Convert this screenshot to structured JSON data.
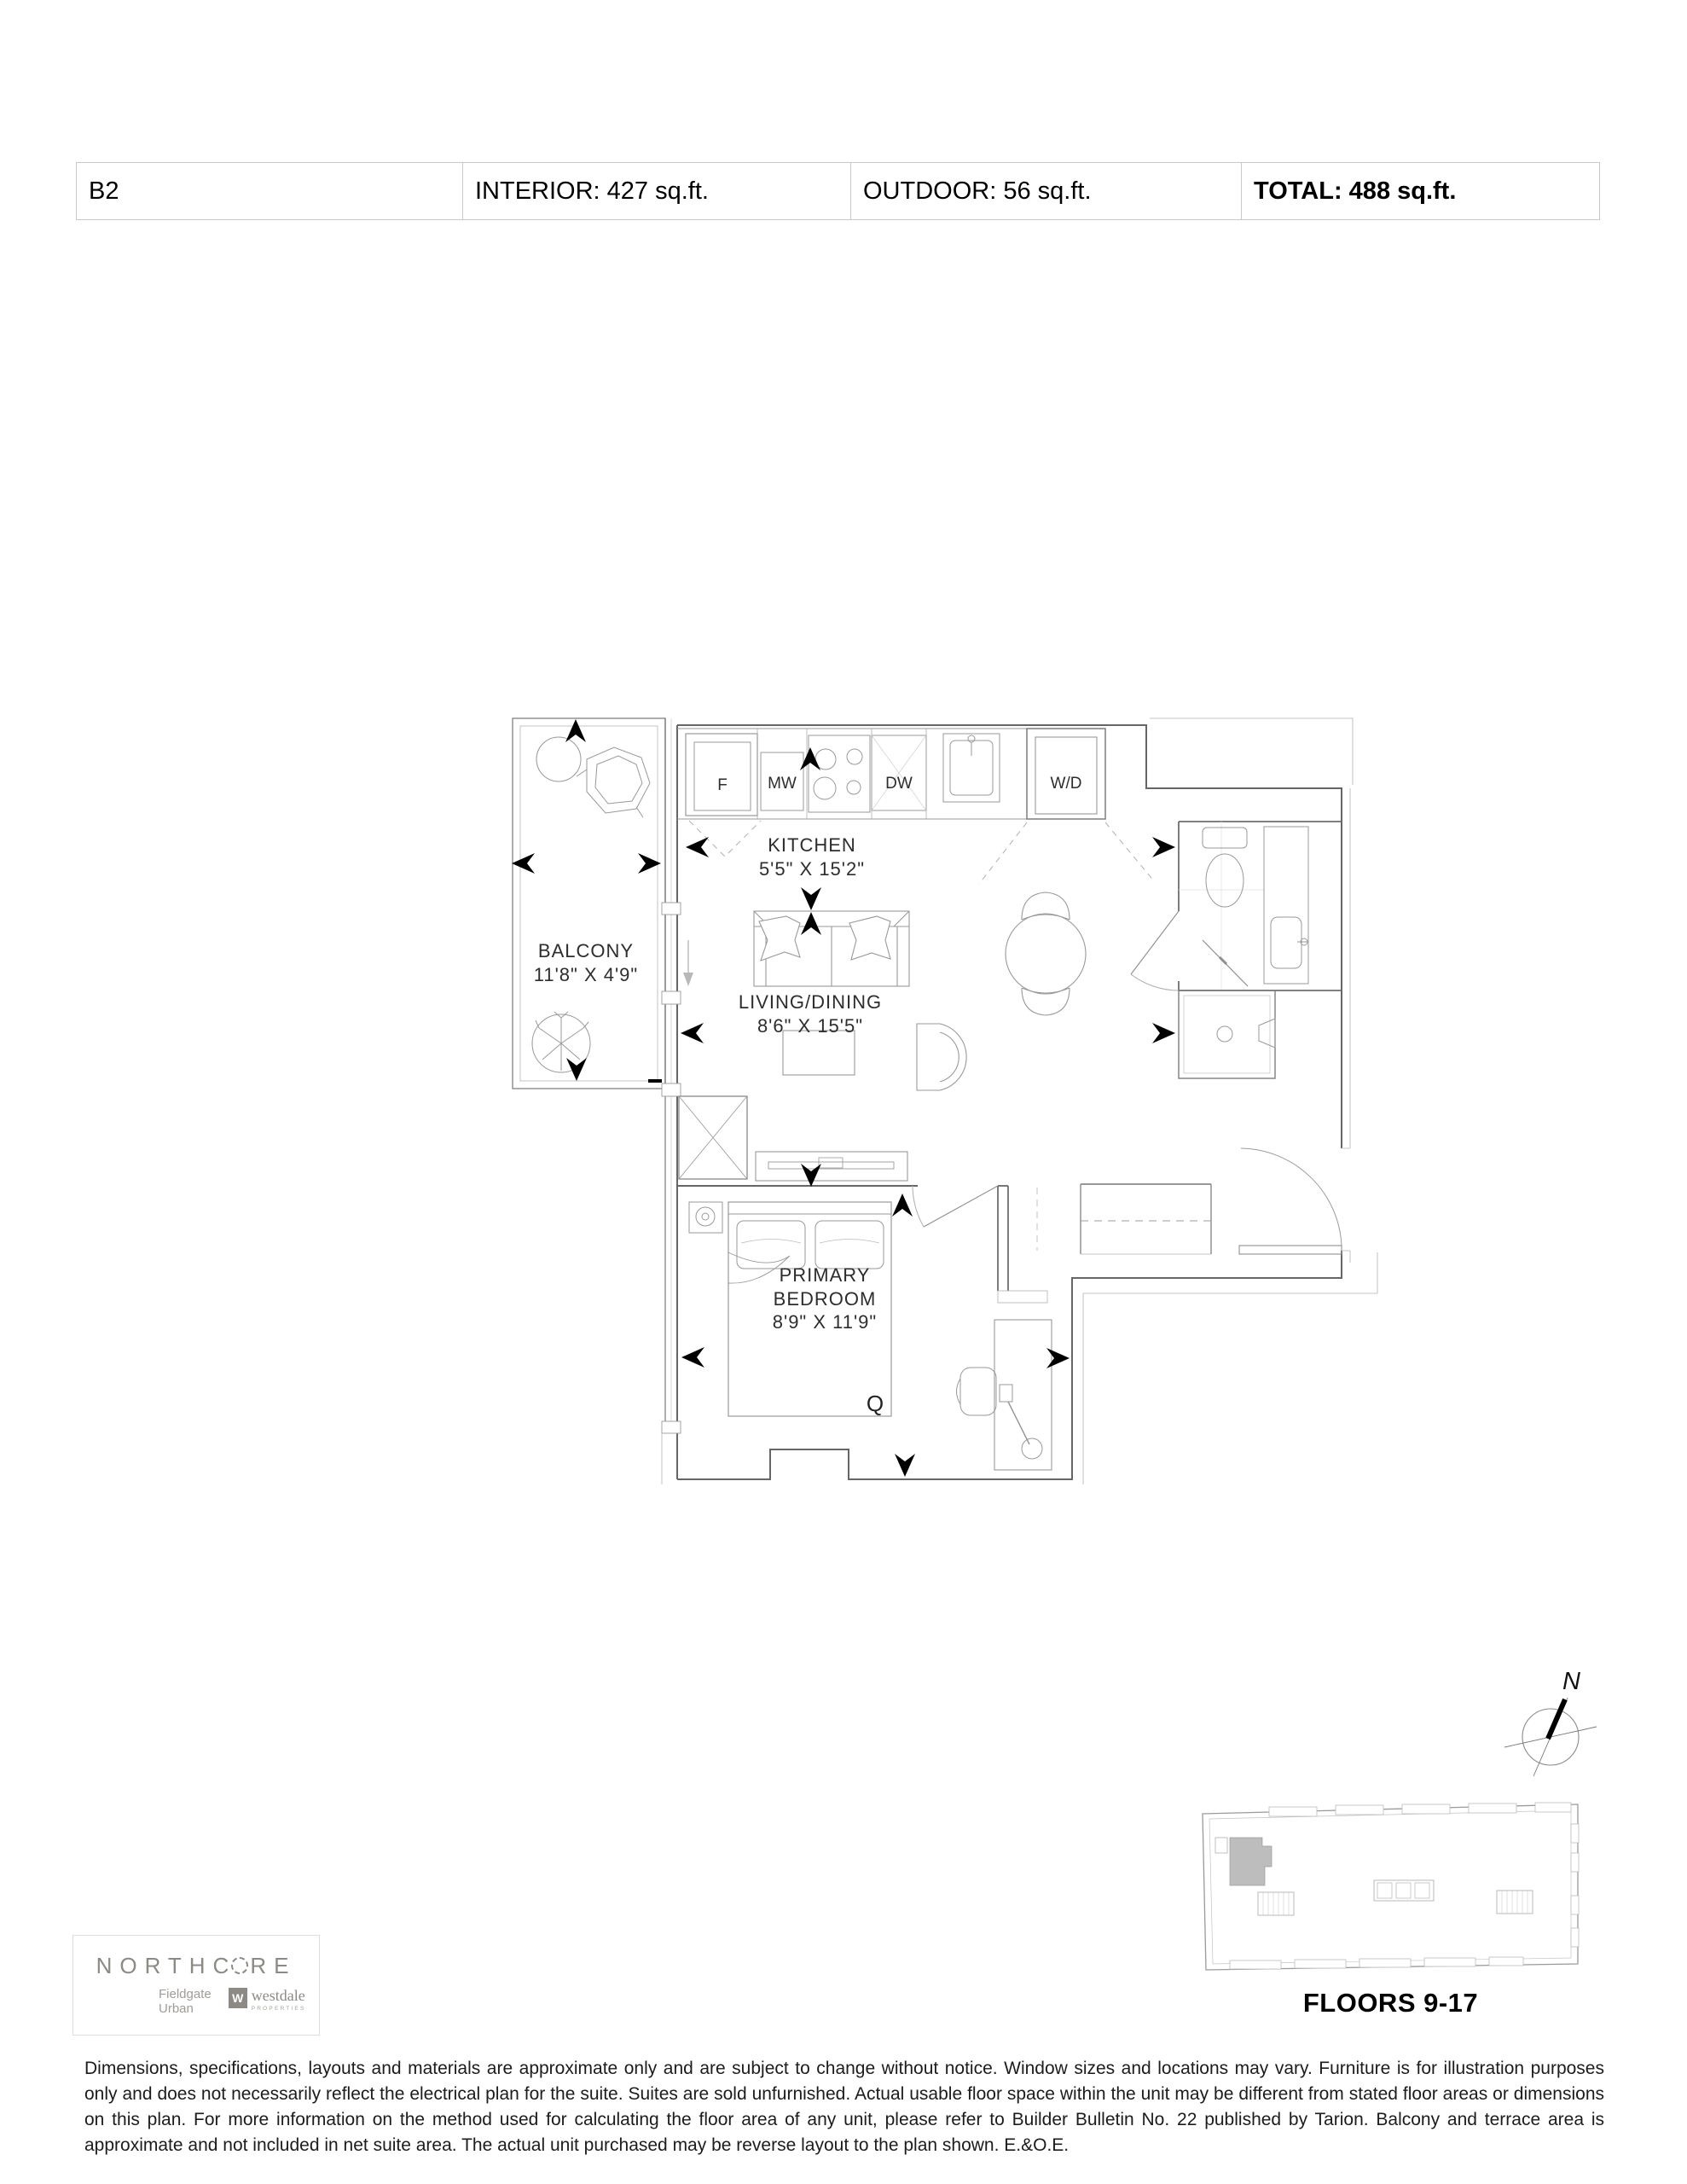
{
  "header": {
    "unit": "B2",
    "interior": "INTERIOR: 427 sq.ft.",
    "outdoor": "OUTDOOR: 56 sq.ft.",
    "total": "TOTAL: 488 sq.ft."
  },
  "plan": {
    "rooms": {
      "kitchen": {
        "name": "KITCHEN",
        "dims": "5'5\" X 15'2\""
      },
      "living": {
        "name": "LIVING/DINING",
        "dims": "8'6\" X 15'5\""
      },
      "bedroom": {
        "line1": "PRIMARY",
        "line2": "BEDROOM",
        "dims": "8'9\" X 11'9\""
      },
      "balcony": {
        "name": "BALCONY",
        "dims": "11'8\" X 4'9\""
      }
    },
    "appliances": {
      "fridge": "F",
      "microwave": "MW",
      "dishwasher": "DW",
      "washer_dryer": "W/D"
    },
    "bed_label": "Q"
  },
  "compass": {
    "north": "N"
  },
  "keyplan": {
    "floors": "FLOORS 9-17"
  },
  "branding": {
    "wordmark_prefix": "NORTHC",
    "wordmark_suffix": "RE",
    "fieldgate_line1": "Fieldgate",
    "fieldgate_line2": "Urban",
    "westdale_mark": "W",
    "westdale_name": "westdale",
    "westdale_sub": "PROPERTIES"
  },
  "disclaimer": "Dimensions, specifications, layouts and materials are approximate only and are subject to change without notice. Window sizes and locations may vary. Furniture is for illustration purposes only and does not necessarily reflect the electrical plan for the suite. Suites are sold unfurnished. Actual usable floor space within the unit may be different from stated floor areas or dimensions on this plan. For more information on the method used for calculating the floor area of any unit, please refer to Builder Bulletin No. 22 published by Tarion. Balcony and terrace area is approximate and not included in net suite area. The actual unit purchased may be reverse layout to the plan shown. E.&O.E.",
  "colors": {
    "wall": "#666666",
    "furniture": "#999999",
    "faint": "#c6c6c6",
    "arrow_black": "#000000",
    "brand_gray": "#8d8a85"
  }
}
